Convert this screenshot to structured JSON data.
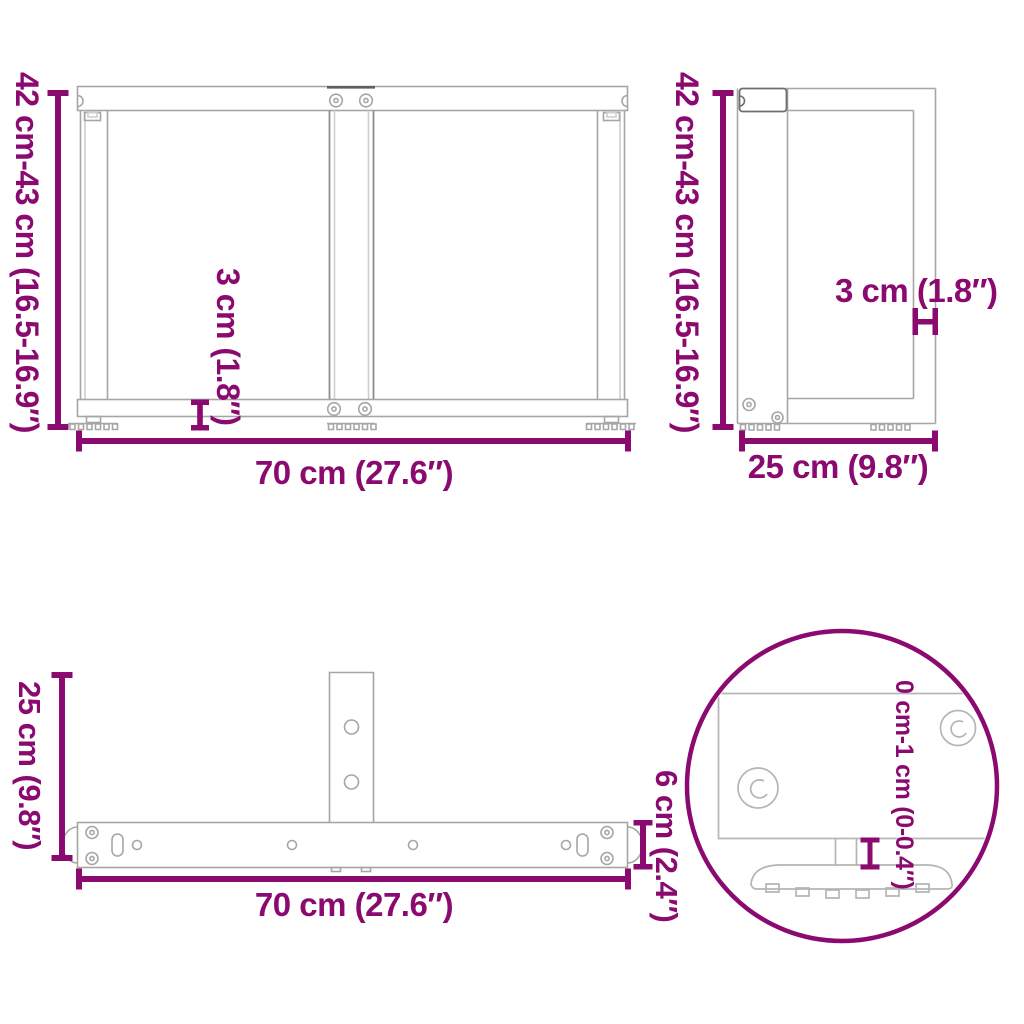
{
  "image_type": "product dimension diagram of T-shaped table legs",
  "colors": {
    "dimension_accent": "#8b0a70",
    "drawing_line": "#a6a6a6",
    "detail_line": "#b5b5b5",
    "background": "#ffffff"
  },
  "views": {
    "front": {
      "height_label": "42 cm-43 cm (16.5-16.9″)",
      "width_label": "70 cm (27.6″)",
      "foot_height_label": "3 cm (1.8″)"
    },
    "side": {
      "height_label": "42 cm-43 cm (16.5-16.9″)",
      "depth_label": "25 cm (9.8″)",
      "arm_thickness_label": "3 cm (1.8″)"
    },
    "top": {
      "depth_label": "25 cm (9.8″)",
      "width_label": "70 cm (27.6″)",
      "bar_width_label": "6 cm (2.4″)"
    },
    "detail": {
      "adjustable_foot_label": "0 cm-1 cm (0-0.4″)"
    }
  }
}
